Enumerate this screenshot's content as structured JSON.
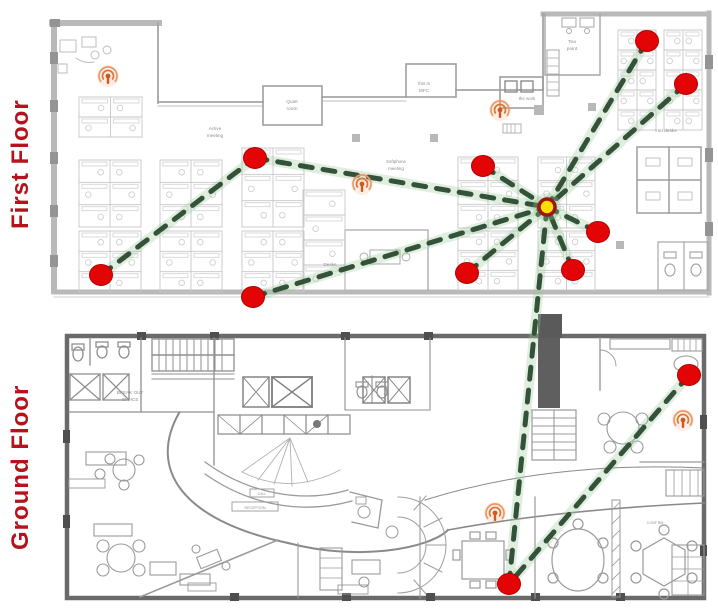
{
  "floors": [
    {
      "id": "first",
      "label": "First Floor",
      "label_color": "#b5121b"
    },
    {
      "id": "ground",
      "label": "Ground Floor",
      "label_color": "#b5121b"
    }
  ],
  "network": {
    "style": {
      "link_color": "#335239",
      "link_glow": "rgba(150,200,150,0.30)",
      "node_color": "#e30505",
      "node_edge": "#b30000",
      "hub_fill": "#ffdf00",
      "hub_ring": "#9e1410",
      "beacon_dot": "#d4561c",
      "beacon_arc": "#db7434",
      "beacon_arc_outer": "#e89a68",
      "beacon_glow": "rgba(235,130,70,0.14)"
    },
    "hub": {
      "id": "hub",
      "name": "gateway-hub",
      "floor": "first",
      "x": 547,
      "y": 207
    },
    "nodes": [
      {
        "id": "n1",
        "floor": "first",
        "x": 255,
        "y": 158
      },
      {
        "id": "n2",
        "floor": "first",
        "x": 101,
        "y": 275
      },
      {
        "id": "n3",
        "floor": "first",
        "x": 253,
        "y": 297
      },
      {
        "id": "n4",
        "floor": "first",
        "x": 483,
        "y": 166
      },
      {
        "id": "n5",
        "floor": "first",
        "x": 647,
        "y": 41
      },
      {
        "id": "n6",
        "floor": "first",
        "x": 686,
        "y": 84
      },
      {
        "id": "n7",
        "floor": "first",
        "x": 598,
        "y": 232
      },
      {
        "id": "n8",
        "floor": "first",
        "x": 573,
        "y": 270
      },
      {
        "id": "n9",
        "floor": "first",
        "x": 467,
        "y": 273
      },
      {
        "id": "n10",
        "floor": "ground",
        "x": 689,
        "y": 375
      },
      {
        "id": "n11",
        "floor": "ground",
        "x": 509,
        "y": 584
      }
    ],
    "beacons": [
      {
        "id": "b1",
        "floor": "first",
        "x": 108,
        "y": 76
      },
      {
        "id": "b2",
        "floor": "first",
        "x": 500,
        "y": 110
      },
      {
        "id": "b3",
        "floor": "first",
        "x": 362,
        "y": 184
      },
      {
        "id": "b4",
        "floor": "ground",
        "x": 683,
        "y": 420
      },
      {
        "id": "b5",
        "floor": "ground",
        "x": 495,
        "y": 513
      }
    ],
    "links": [
      {
        "from": "n2",
        "to": "n1"
      },
      {
        "from": "n1",
        "to": "hub"
      },
      {
        "from": "n3",
        "to": "hub"
      },
      {
        "from": "n4",
        "to": "hub"
      },
      {
        "from": "n5",
        "to": "hub"
      },
      {
        "from": "n6",
        "to": "hub"
      },
      {
        "from": "n7",
        "to": "hub"
      },
      {
        "from": "n8",
        "to": "hub"
      },
      {
        "from": "n9",
        "to": "hub"
      },
      {
        "from": "hub",
        "to": "n11"
      },
      {
        "from": "n10",
        "to": "n11"
      }
    ]
  },
  "plan_texts": [
    {
      "floor": "first",
      "text": "Active",
      "x": 215,
      "y": 130,
      "size": 4.6
    },
    {
      "floor": "first",
      "text": "meeting",
      "x": 215,
      "y": 137,
      "size": 4.6
    },
    {
      "floor": "first",
      "text": "Quiet",
      "x": 292,
      "y": 103,
      "size": 4.8
    },
    {
      "floor": "first",
      "text": "room",
      "x": 292,
      "y": 110,
      "size": 4.8
    },
    {
      "floor": "first",
      "text": "this is",
      "x": 424,
      "y": 85,
      "size": 4.6
    },
    {
      "floor": "first",
      "text": "MFC",
      "x": 424,
      "y": 92,
      "size": 4.6
    },
    {
      "floor": "first",
      "text": "the work",
      "x": 527,
      "y": 100,
      "size": 4.4
    },
    {
      "floor": "first",
      "text": "Softphone",
      "x": 396,
      "y": 163,
      "size": 4.4
    },
    {
      "floor": "first",
      "text": "meeting",
      "x": 396,
      "y": 170,
      "size": 4.4
    },
    {
      "floor": "first",
      "text": "Tea",
      "x": 572,
      "y": 43,
      "size": 4.8
    },
    {
      "floor": "first",
      "text": "point",
      "x": 572,
      "y": 50,
      "size": 4.8
    },
    {
      "floor": "first",
      "text": "Hot desks",
      "x": 666,
      "y": 132,
      "size": 4.8
    },
    {
      "floor": "first",
      "text": "Desks",
      "x": 330,
      "y": 266,
      "size": 4.8
    },
    {
      "floor": "ground",
      "text": "BREAK OUT",
      "x": 130,
      "y": 394,
      "size": 4.6
    },
    {
      "floor": "ground",
      "text": "OFFICE",
      "x": 130,
      "y": 401,
      "size": 4.6
    },
    {
      "floor": "ground",
      "text": "CALL",
      "x": 262,
      "y": 495,
      "size": 3.4
    },
    {
      "floor": "ground",
      "text": "RECEPTION",
      "x": 255,
      "y": 509,
      "size": 3.6
    },
    {
      "floor": "ground",
      "text": "CONF RM",
      "x": 655,
      "y": 524,
      "size": 3.6
    }
  ]
}
